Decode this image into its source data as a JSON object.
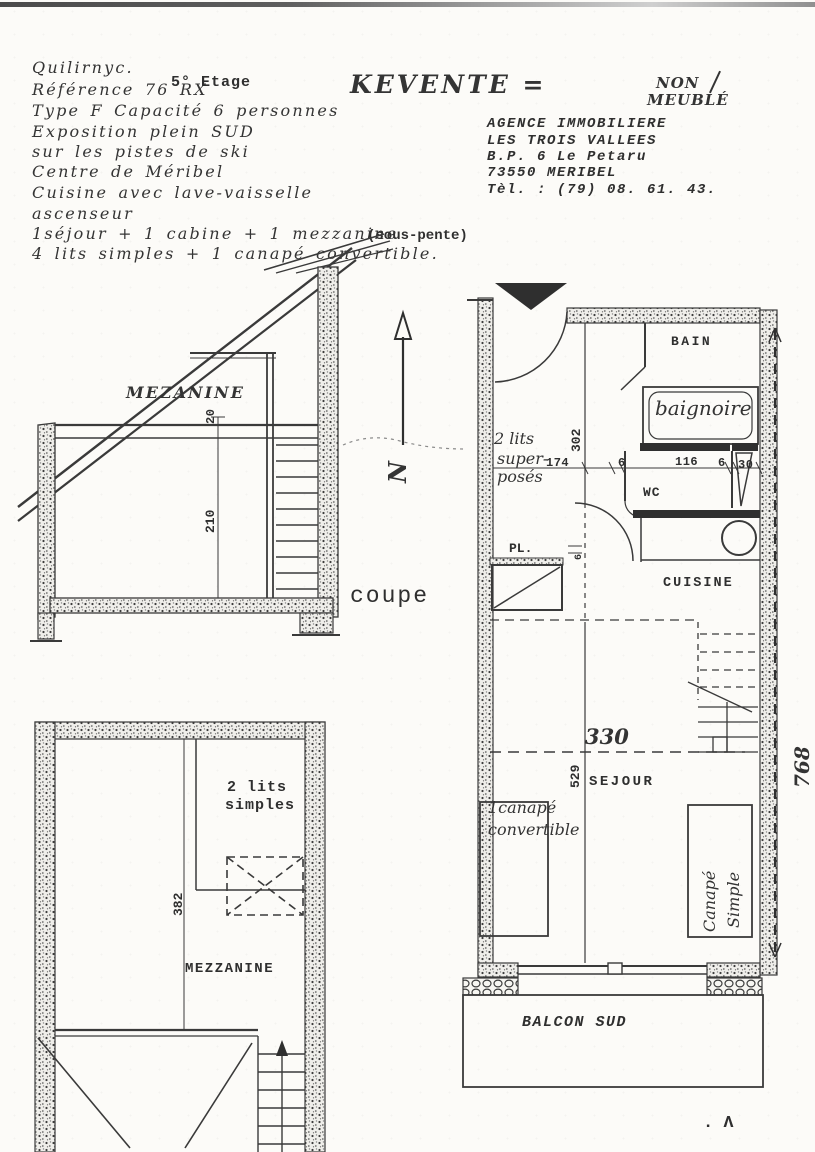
{
  "colors": {
    "ink": "#343434",
    "paper": "#fcfbf8"
  },
  "header": {
    "handwritten_lines": [
      "Quilirnyc.",
      "Référence 76 RX",
      "Type F Capacité 6 personnes",
      "Exposition plein SUD",
      "sur les pistes de ski",
      "Centre de Méribel",
      "Cuisine avec lave-vaisselle",
      "ascenseur",
      "1séjour + 1 cabine + 1 mezzanine",
      "4 lits simples + 1 canapé convertible."
    ],
    "floor_typed": "5° Etage",
    "sous_pente_typed": "(sous-pente)",
    "sale_title": "KEVENTE =",
    "non_meuble": [
      "NON",
      "MEUBLÉ"
    ],
    "agency_lines": [
      "AGENCE IMMOBILIERE",
      "LES TROIS VALLEES",
      "B.P. 6 Le Petaru",
      "73550 MERIBEL",
      "Tèl. : (79) 08. 61. 43."
    ]
  },
  "coupe": {
    "label": "coupe",
    "room": "MEZANINE",
    "dim_top": "20",
    "dim_height": "210",
    "north_letter": "N"
  },
  "plan": {
    "rooms": {
      "bain": "BAIN",
      "baignoire": "baignoire",
      "wc": "WC",
      "placard": "PL.",
      "cuisine": "CUISINE",
      "sejour": "SEJOUR",
      "balcon": "BALCON SUD"
    },
    "notes": {
      "lits_superposes": [
        "2 lits",
        "super-",
        "posés"
      ],
      "canape_convertible": [
        "1canapé",
        "convertible"
      ],
      "canape_simple": [
        "Canapé",
        "Simple"
      ]
    },
    "dims": {
      "depth_hall": "302",
      "width_cabine": "174",
      "d6a": "6",
      "width_bain": "116",
      "d6b": "6",
      "d30": "30",
      "door": "6",
      "width_sejour": "330",
      "depth_sejour": "529",
      "total_depth": "768"
    }
  },
  "mezzanine_plan": {
    "room": "MEZZANINE",
    "beds": [
      "2 lits",
      "simples"
    ],
    "dim_depth": "382"
  },
  "page_mark": ". Λ"
}
